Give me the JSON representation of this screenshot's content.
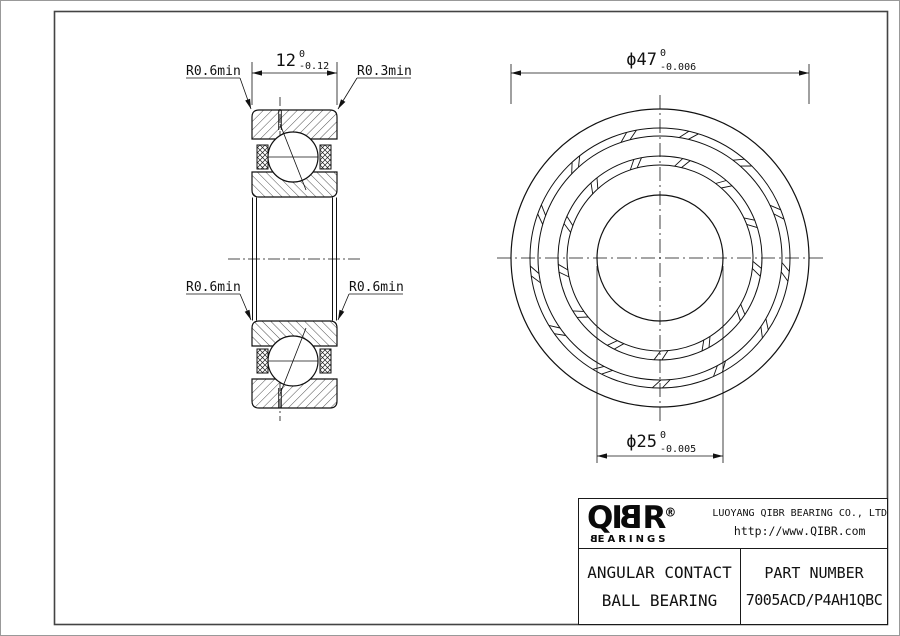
{
  "drawing": {
    "labels": {
      "top_left": "R0.6min",
      "top_right": "R0.3min",
      "bottom_left": "R0.6min",
      "bottom_right": "R0.6min"
    },
    "dimensions": {
      "width": {
        "value": "12",
        "tol_upper": "0",
        "tol_lower": "-0.12"
      },
      "outer_diameter": {
        "value": "ϕ47",
        "tol_upper": "0",
        "tol_lower": "-0.006"
      },
      "bore_diameter": {
        "value": "ϕ25",
        "tol_upper": "0",
        "tol_lower": "-0.005"
      }
    }
  },
  "title_block": {
    "logo": {
      "prefix": "QI",
      "mirrored_letter": "B",
      "suffix": "R",
      "registered": "®",
      "sub_mirrored": "B",
      "sub_rest": "EARINGS"
    },
    "company": "LUOYANG QIBR BEARING CO., LTD",
    "website": "http://www.QIBR.com",
    "product": {
      "line1": "ANGULAR CONTACT",
      "line2": "BALL BEARING"
    },
    "part": {
      "label": "PART NUMBER",
      "number": "7005ACD/P4AH1QBC"
    }
  }
}
